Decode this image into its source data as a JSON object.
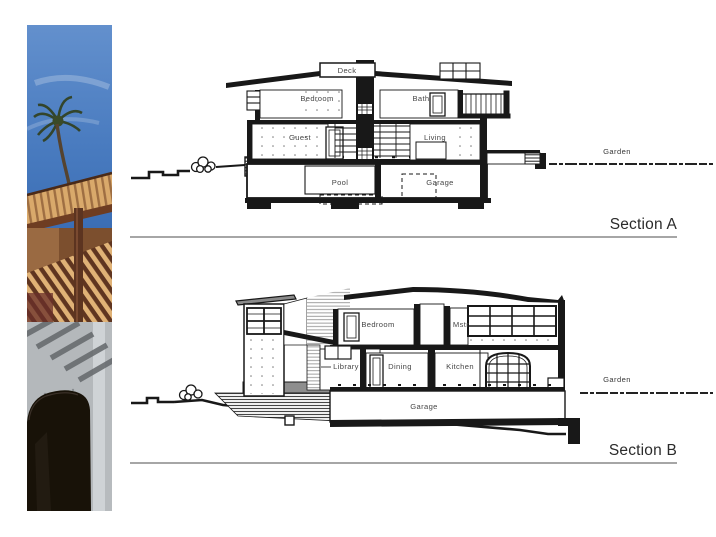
{
  "slide": {
    "background": "#ffffff"
  },
  "sections": {
    "a": {
      "title": "Section A",
      "garden_label": "Garden",
      "rooms": {
        "deck": "Deck",
        "bedroom": "Bedroom",
        "bath": "Bath",
        "guest": "Guest",
        "living": "Living",
        "pool": "Pool",
        "garage": "Garage"
      }
    },
    "b": {
      "title": "Section B",
      "garden_label": "Garden",
      "rooms": {
        "bedroom": "Bedroom",
        "master": "Mstr",
        "library": "Library",
        "dining": "Dining",
        "kitchen": "Kitchen",
        "garage": "Garage"
      }
    }
  },
  "colors": {
    "drawing_ink": "#181818",
    "label_text": "#474747",
    "title_text": "#2b2b2b",
    "underline_gray": "#a6a6a6",
    "sky_blue": "#4a7cc0",
    "palm_green": "#31401f",
    "pergola_wood": "#d9a96b",
    "pergola_shadow": "#6e3d22",
    "concrete_gray": "#b4b8bb",
    "arch_dark": "#181208"
  }
}
